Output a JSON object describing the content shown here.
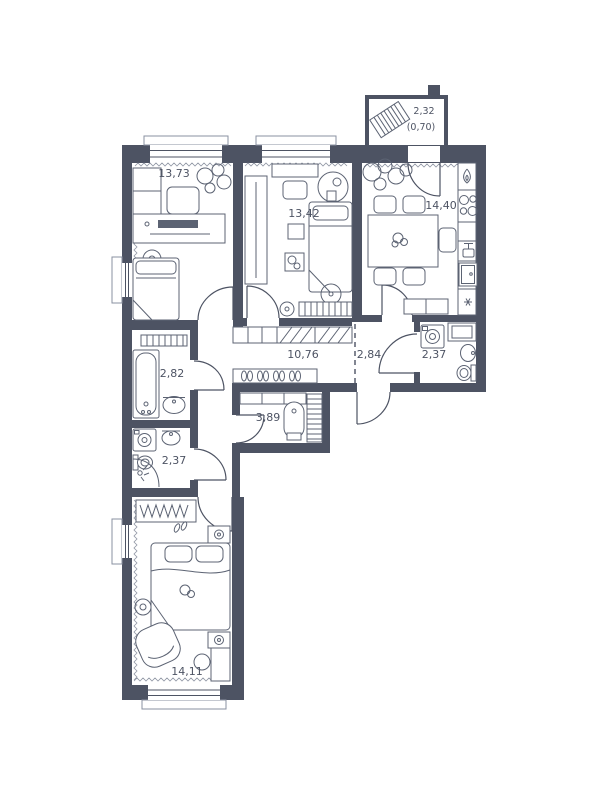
{
  "floor_plan": {
    "background": "#ffffff",
    "wall_color": "#4d5363",
    "furniture_color": "#5c6373",
    "text_color": "#4d5363",
    "rooms": [
      {
        "name": "room-13-73",
        "area": "13,73"
      },
      {
        "name": "room-13-42",
        "area": "13,42"
      },
      {
        "name": "kitchen",
        "area": "14,40"
      },
      {
        "name": "corridor",
        "area": "10,76"
      },
      {
        "name": "hallway",
        "area": "2,84"
      },
      {
        "name": "bathroom-right",
        "area": "2,37"
      },
      {
        "name": "bathroom-left",
        "area": "2,82"
      },
      {
        "name": "storage",
        "area": "3,89"
      },
      {
        "name": "wc",
        "area": "2,37"
      },
      {
        "name": "bedroom",
        "area": "14,11"
      },
      {
        "name": "balcony",
        "area": "2,32",
        "area_weighted": "(0,70)"
      }
    ],
    "furniture_icons": [
      "bed",
      "pillow",
      "desk",
      "monitor",
      "chair",
      "armchair",
      "wardrobe",
      "coat-rack",
      "shoe-shelf",
      "dining-table",
      "plant",
      "stove",
      "gas-flame",
      "kitchen-sink",
      "oven",
      "bathtub",
      "sink",
      "toilet",
      "washing-machine",
      "shower",
      "ceiling-light",
      "boiler",
      "ladder",
      "balcony-bench",
      "pouf",
      "nightstand",
      "towel-radiator",
      "slippers"
    ]
  }
}
